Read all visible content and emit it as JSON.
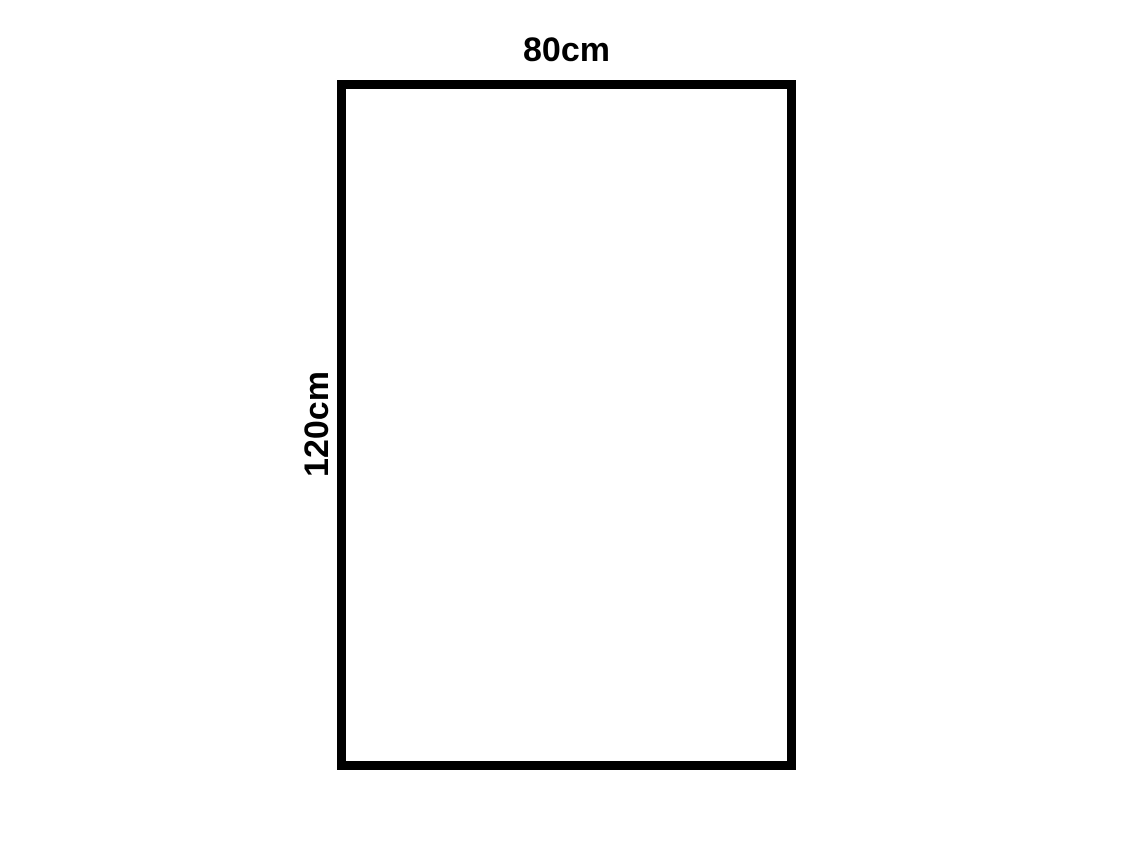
{
  "diagram": {
    "type": "rectangle-dimension-diagram",
    "shape": "rectangle",
    "width_label": "80cm",
    "height_label": "120cm",
    "border_color": "#000000",
    "fill_color": "#ffffff",
    "background_color": "#ffffff"
  }
}
